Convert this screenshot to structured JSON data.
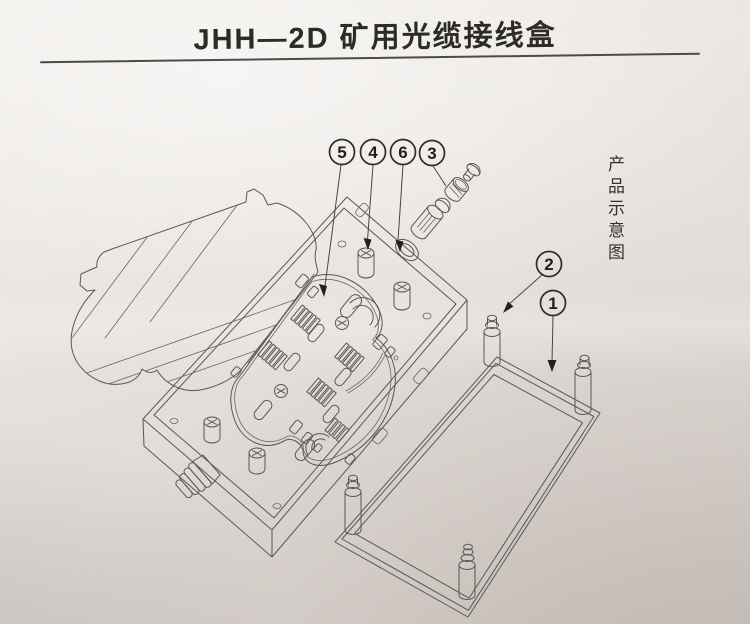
{
  "page": {
    "title": "JHH—2D 矿用光缆接线盒",
    "side_caption": "产品示意图"
  },
  "callouts": [
    {
      "label": "5"
    },
    {
      "label": "4"
    },
    {
      "label": "6"
    },
    {
      "label": "3"
    },
    {
      "label": "2"
    },
    {
      "label": "1"
    }
  ],
  "colors": {
    "paper": "#e7e3df",
    "line": "#5b5752",
    "ink": "#2d2b28"
  }
}
